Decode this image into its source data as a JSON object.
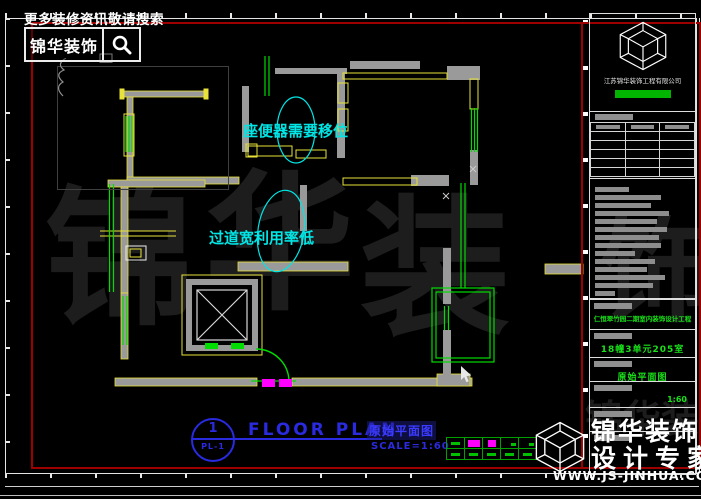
{
  "colors": {
    "wall_gray": "#9a9a9a",
    "cad_yellow": "#e8e23a",
    "cad_green": "#00dd00",
    "cad_cyan": "#00e5e5",
    "cad_blue": "#2a2ae0",
    "cad_magenta": "#ff00ff",
    "border_red": "#9e0000",
    "badge_green": "#00b400"
  },
  "promo": {
    "headline": "更多装修资讯敬请搜索",
    "search_brand": "锦华装饰"
  },
  "plan": {
    "annotation_toilet": "座便器需要移位",
    "annotation_corridor": "过道宽利用率低"
  },
  "sheet": {
    "number": "1",
    "code": "PL-1",
    "title_en": "FLOOR PLAN",
    "title_cn": "原始平面图",
    "scale": "SCALE=1:60"
  },
  "titleblock": {
    "company": "江苏锦华装饰工程有限公司",
    "project": "仁恒翠竹园二期室内装饰设计工程",
    "unit": "18幢3单元205室",
    "drawing_name": "原始平面图",
    "scale": "1:60"
  },
  "brand": {
    "name": "锦华装饰",
    "tagline": "设计专家",
    "website": "WWW.JS-JINHUA.COM"
  },
  "watermark": {
    "char1": "锦",
    "char2": "华",
    "char3": "装",
    "char4": "饰",
    "small": "锦华装饰"
  }
}
